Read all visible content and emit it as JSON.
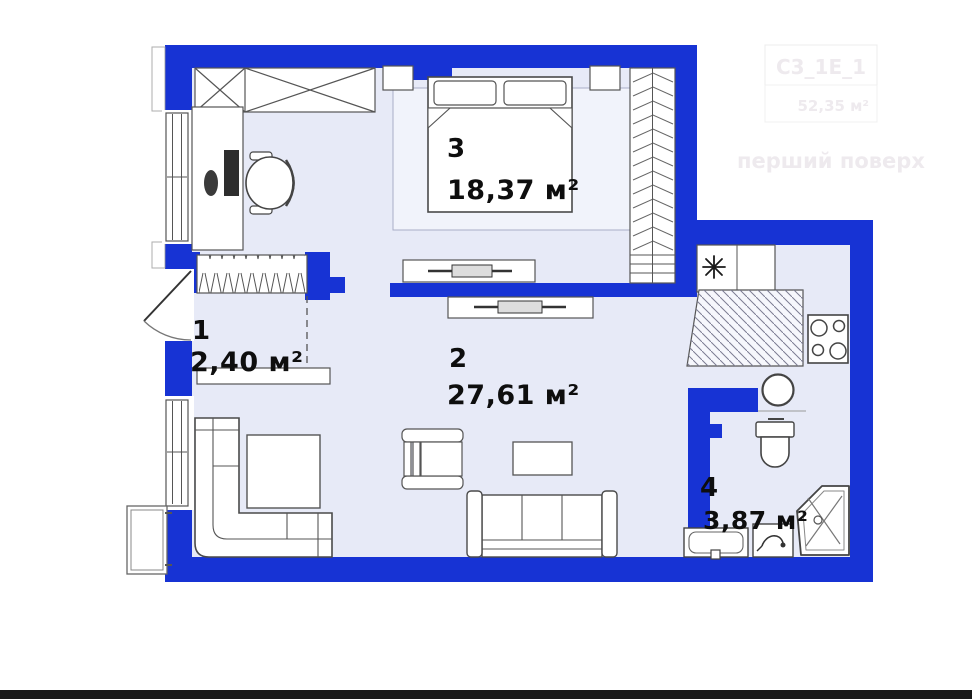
{
  "plan": {
    "rooms": {
      "hallway": {
        "number": "1",
        "area": "2,40 м²"
      },
      "living_room": {
        "number": "2",
        "area": "27,61 м²"
      },
      "bedroom": {
        "number": "3",
        "area": "18,37 м²"
      },
      "bathroom": {
        "number": "4",
        "area": "3,87 м²"
      }
    },
    "watermark": {
      "plan_code": "C3_1E_1",
      "total_area": "52,35 м²",
      "floor_name": "перший поверх"
    }
  },
  "palette": {
    "wall_blue": "#1733d4",
    "floor": "#e7eaf7",
    "furniture_outline": "#4a4a4a",
    "label_color": "#0e0e0e",
    "watermark_color": "#eeeaee",
    "photo_edge": "#191919"
  },
  "icons": {
    "ventilation-icon": "✳ (8-spoke asterisk, kitchen vent)",
    "door-swing-icon": "quarter-arc entrance door",
    "shower-drain-icon": "small circle"
  }
}
